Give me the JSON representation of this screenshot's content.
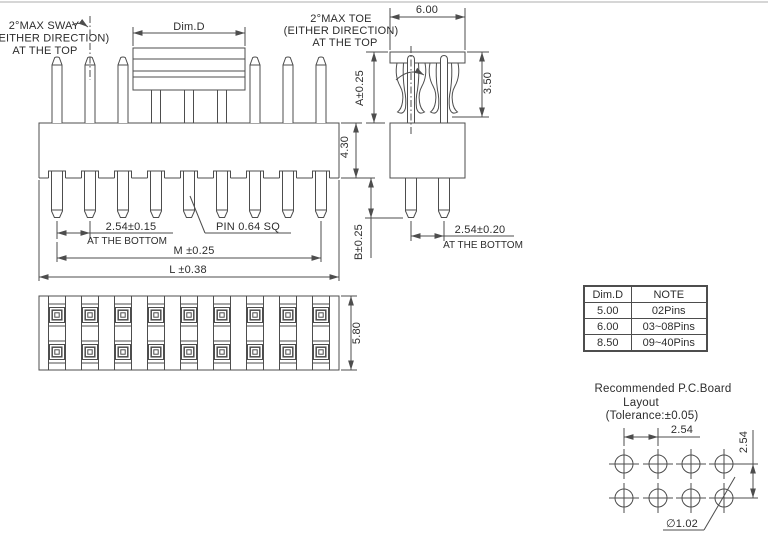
{
  "colors": {
    "line": "#4d4d4d",
    "text": "#2d2d2d",
    "background": "#ffffff"
  },
  "front_view": {
    "sway_note": [
      "2°MAX SWAY",
      "(EITHER  DIRECTION)",
      "AT THE TOP"
    ],
    "cap_width_label": "Dim.D",
    "pitch_label": "2.54±0.15",
    "pitch_note": "AT THE BOTTOM",
    "pin_size_label": "PIN 0.64 SQ",
    "span_label": "M ±0.25",
    "length_label": "L ±0.38",
    "body_height_label": "4.30"
  },
  "side_view": {
    "toe_note": [
      "2°MAX TOE",
      "(EITHER  DIRECTION)",
      "AT THE TOP"
    ],
    "cap_depth_label": "6.00",
    "clip_height_label": "3.50",
    "top_pin_label": "A±0.25",
    "bottom_pin_label": "B±0.25",
    "pitch_label": "2.54±0.20",
    "pitch_note": "AT THE BOTTOM"
  },
  "top_view": {
    "width_label": "5.80"
  },
  "dim_table": {
    "headers": [
      "Dim.D",
      "NOTE"
    ],
    "rows": [
      [
        "5.00",
        "02Pins"
      ],
      [
        "6.00",
        "03~08Pins"
      ],
      [
        "8.50",
        "09~40Pins"
      ]
    ]
  },
  "pcb_layout": {
    "title": [
      "Recommended P.C.Board",
      "Layout",
      "(Tolerance:±0.05)"
    ],
    "pitch_x_label": "2.54",
    "pitch_y_label": "2.54",
    "hole_dia_label": "∅1.02"
  }
}
